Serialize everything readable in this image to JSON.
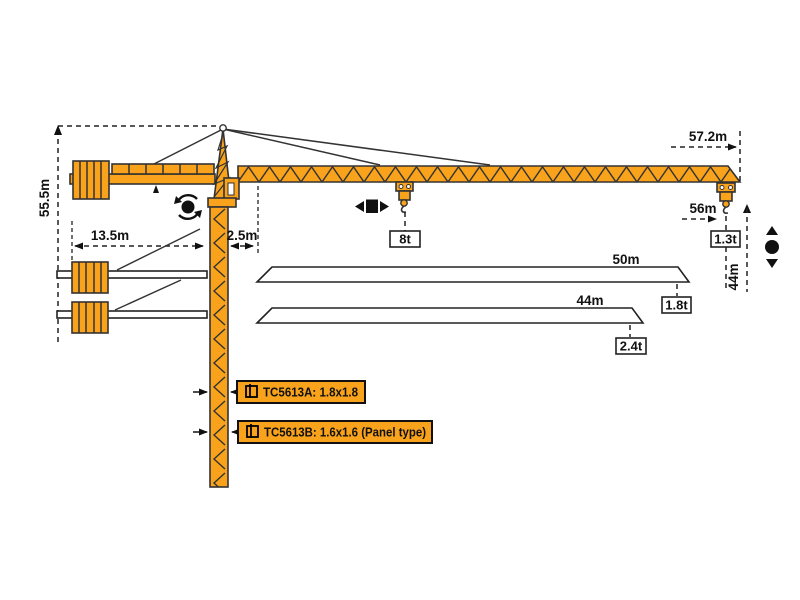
{
  "diagram": {
    "type": "tower-crane-specification-diagram",
    "colors": {
      "crane": "#F9A21B",
      "outline": "#333333",
      "dimension": "#111111"
    },
    "dims": {
      "total_height": "55.5m",
      "counter_jib_length": "13.5m",
      "mast_offset": "2.5m",
      "max_radius": "57.2m",
      "tip_hook_radius": "56m",
      "tip_hook_height": "44m",
      "jib_option_50": "50m",
      "jib_option_44": "44m"
    },
    "loads": {
      "max_load": "8t",
      "tip_load_57m": "1.3t",
      "tip_load_50m": "1.8t",
      "tip_load_44m": "2.4t"
    },
    "models": {
      "a": "TC5613A: 1.8x1.8",
      "b": "TC5613B: 1.6x1.6 (Panel type)"
    }
  }
}
